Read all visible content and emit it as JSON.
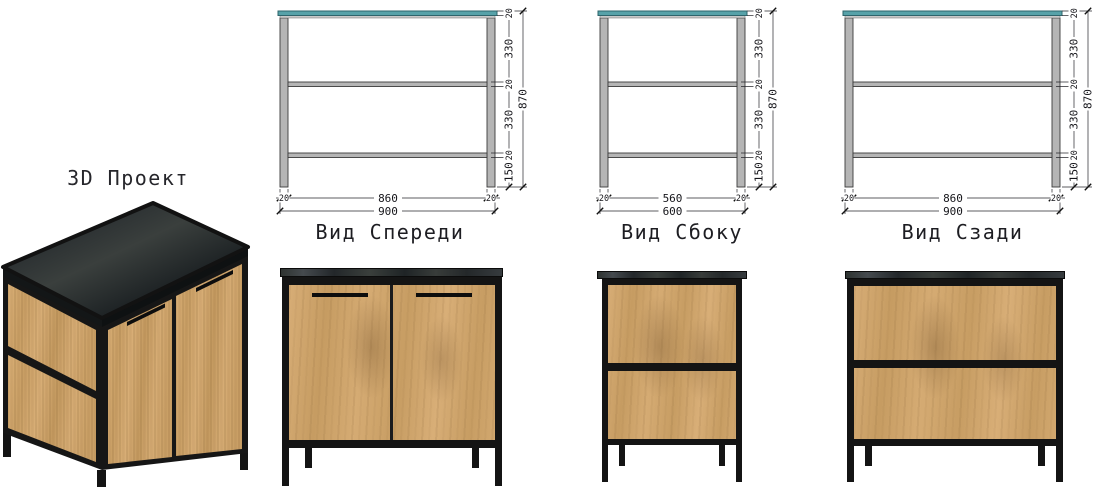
{
  "project": {
    "label": "3D Проект"
  },
  "views": {
    "front": {
      "title": "Вид Спереди",
      "right_chain": [
        "20",
        "330",
        "20",
        "330",
        "20",
        "150"
      ],
      "total_height": "870",
      "bottom_inner": [
        "20",
        "860",
        "20"
      ],
      "bottom_outer": "900"
    },
    "side": {
      "title": "Вид Сбоку",
      "right_chain": [
        "20",
        "330",
        "20",
        "330",
        "20",
        "150"
      ],
      "total_height": "870",
      "bottom_inner": [
        "20",
        "560",
        "20"
      ],
      "bottom_outer": "600"
    },
    "back": {
      "title": "Вид Сзади",
      "right_chain": [
        "20",
        "330",
        "20",
        "330",
        "20",
        "150"
      ],
      "total_height": "870",
      "bottom_inner": [
        "20",
        "860",
        "20"
      ],
      "bottom_outer": "900"
    }
  },
  "colors": {
    "background": "#ffffff",
    "tabletop-teal": "#57a2a9",
    "tabletop-teal-edge": "#2e646b",
    "frame-gray": "#b5b5b5",
    "frame-gray-edge": "#3a3a3a",
    "dim-line": "#26262b",
    "metal-black": "#141414",
    "wood-light": "#d7ad76",
    "wood-dark": "#c79d63",
    "slab-dark": "#26292b"
  }
}
